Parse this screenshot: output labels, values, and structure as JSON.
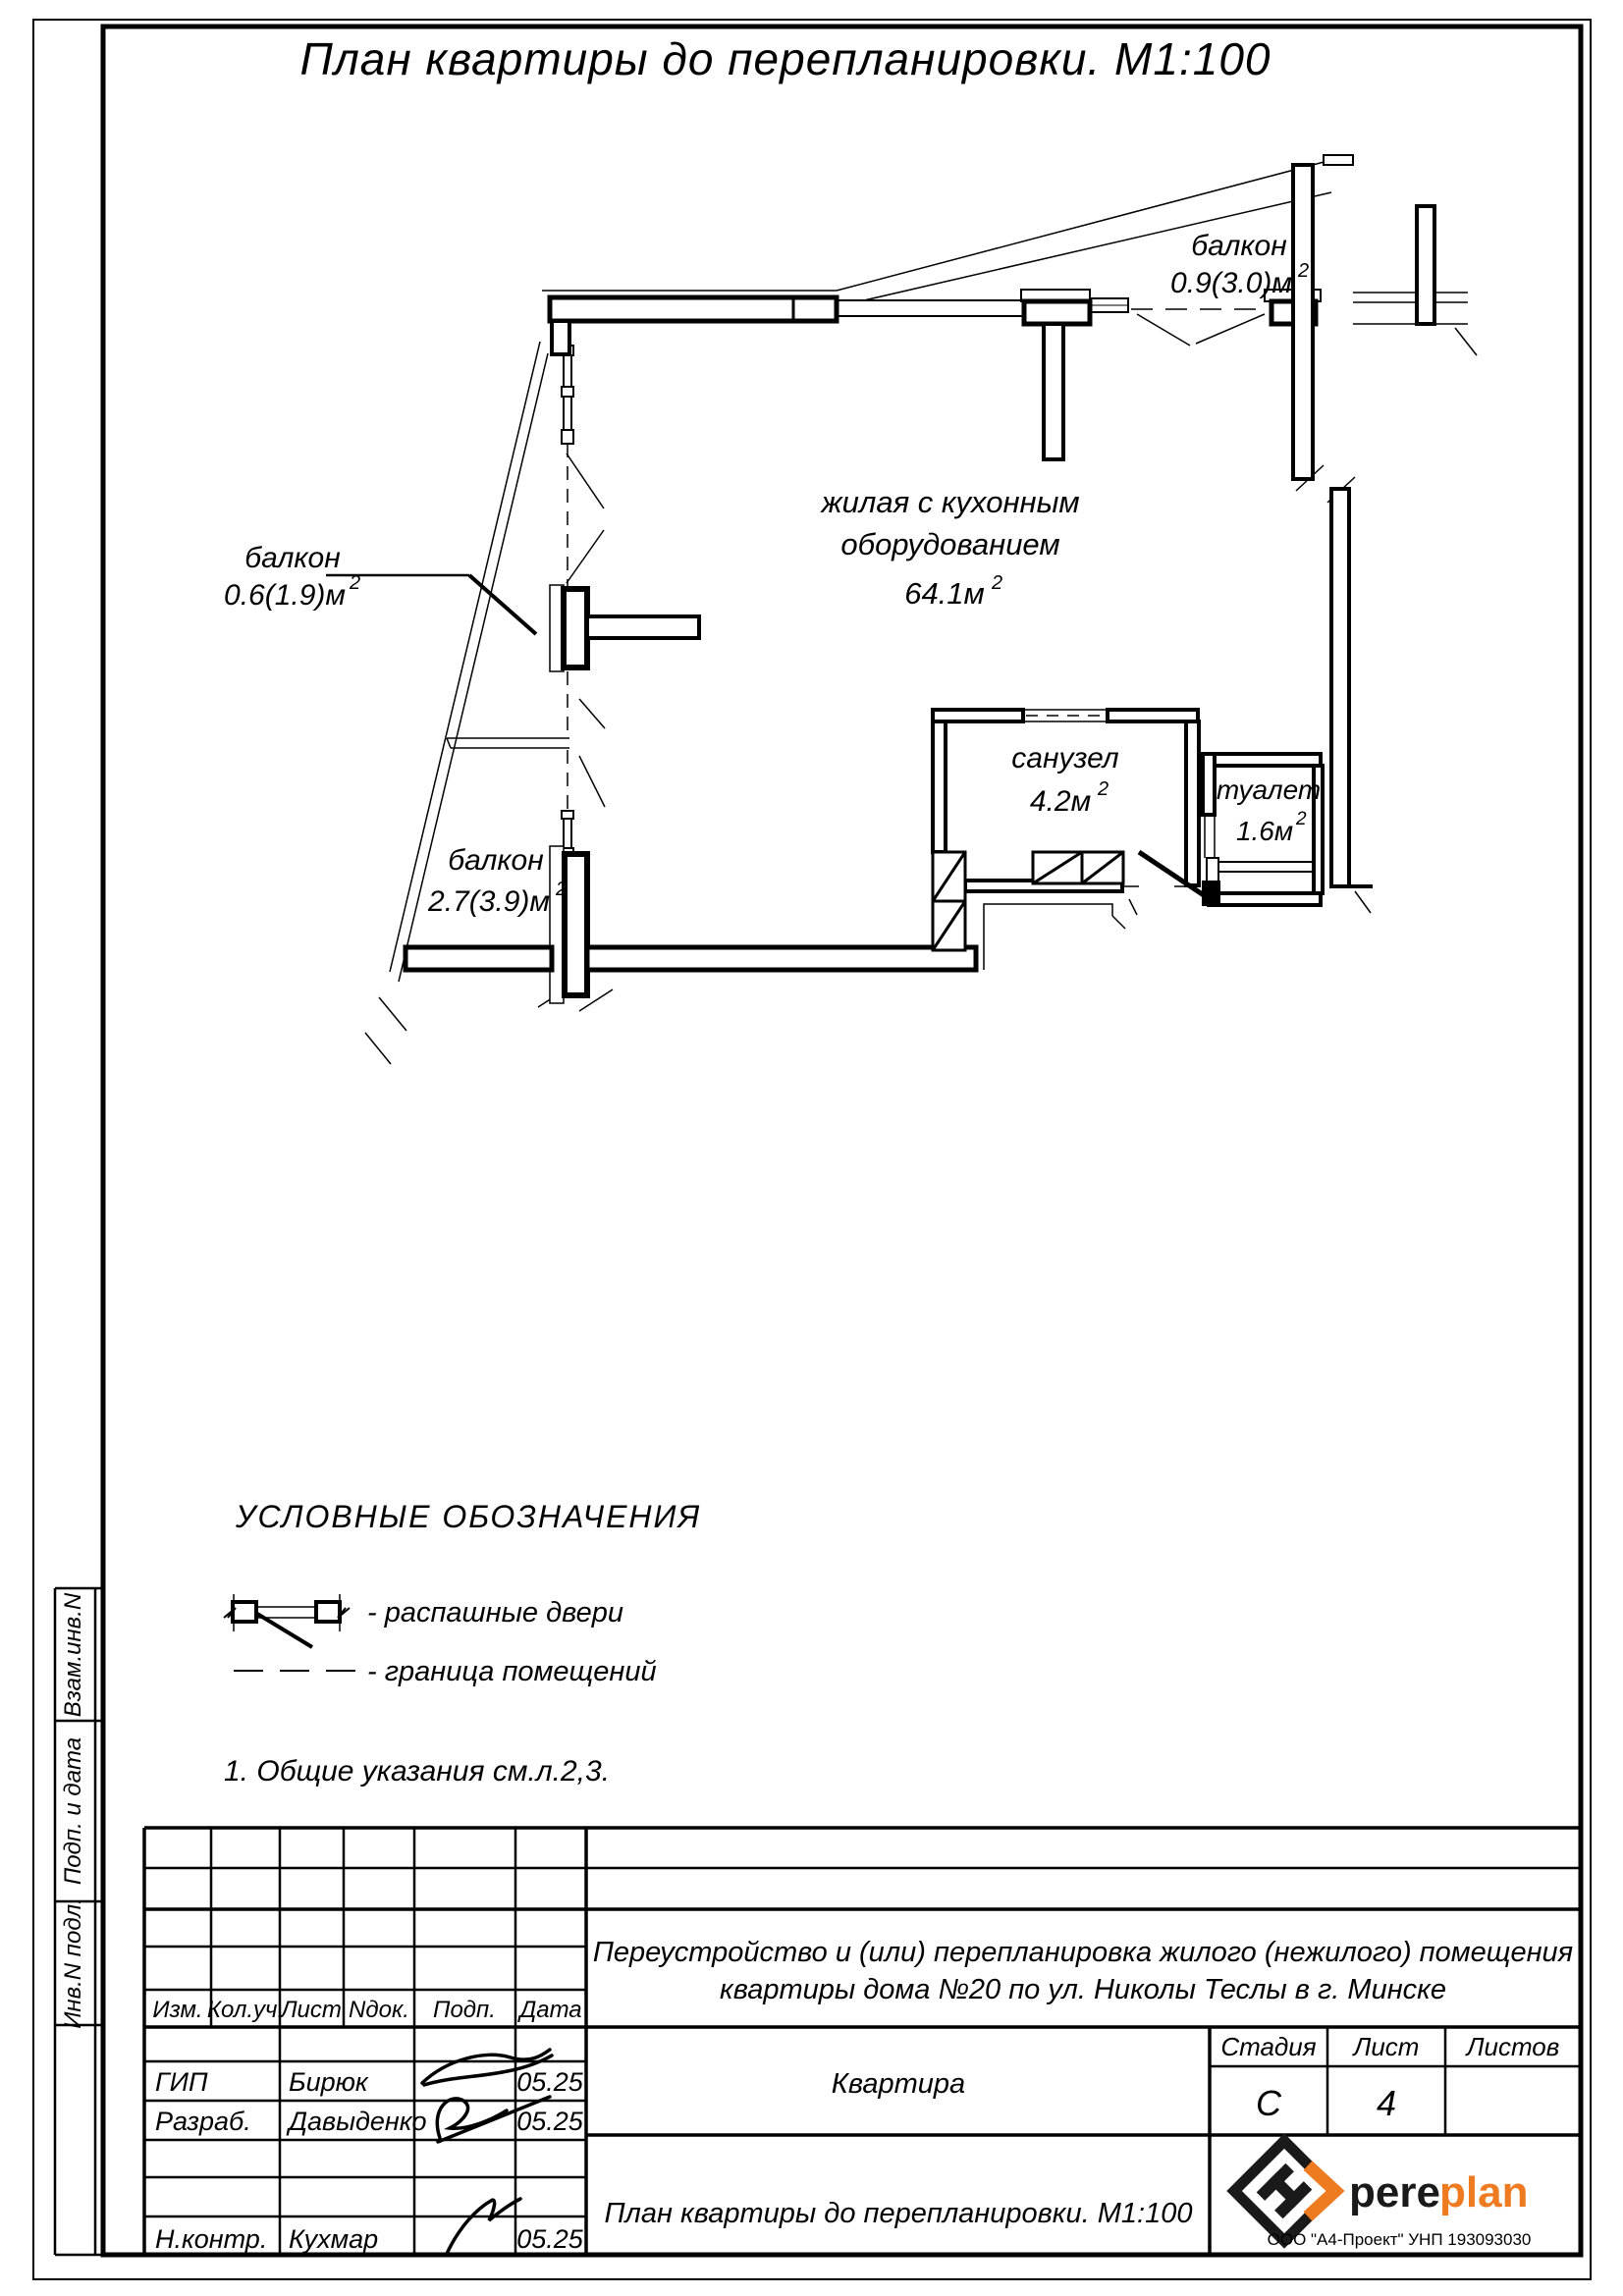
{
  "page": {
    "title": "План квартиры до  перепланировки. М1:100"
  },
  "plan": {
    "sup": "2",
    "living": {
      "l1": "жилая с кухонным",
      "l2": "оборудованием",
      "area": "64.1м"
    },
    "balcony_top": {
      "label": "балкон",
      "area": "0.9(3.0)м"
    },
    "balcony_mid": {
      "label": "балкон",
      "area": "0.6(1.9)м"
    },
    "balcony_low": {
      "label": "балкон",
      "area": "2.7(3.9)м"
    },
    "bathroom": {
      "label": "санузел",
      "area": "4.2м"
    },
    "toilet": {
      "label": "туалет",
      "area": "1.6м"
    }
  },
  "legend": {
    "header": "УСЛОВНЫЕ ОБОЗНАЧЕНИЯ",
    "doors": "-  распашные двери",
    "boundary": "-  граница помещений",
    "note": "1.  Общие указания см.л.2,3."
  },
  "stamp_side": {
    "v1": "Взам.инв.N",
    "v2": "Подп. и дата",
    "v3": "Инв.N подл."
  },
  "titleblock": {
    "cols": {
      "izm": "Изм.",
      "kol": "Кол.уч.",
      "list": "Лист",
      "ndok": "Nдок.",
      "podp": "Подп.",
      "data": "Дата"
    },
    "rows": [
      {
        "role": "ГИП",
        "name": "Бирюк",
        "date": "05.25"
      },
      {
        "role": "Разраб.",
        "name": "Давыденко",
        "date": "05.25"
      },
      {
        "role": "Н.контр.",
        "name": "Кухмар",
        "date": "05.25"
      }
    ],
    "desc1": "Переустройство и (или) перепланировка жилого (нежилого) помещения",
    "desc2": "квартиры дома №20 по ул. Николы Теслы в г. Минске",
    "object": "Квартира",
    "stage_label": "Стадия",
    "sheet_label": "Лист",
    "sheets_label": "Листов",
    "stage": "С",
    "sheet": "4",
    "doc": "План квартиры до  перепланировки. М1:100",
    "logo": {
      "black": "pere",
      "orange": "plan",
      "company": "ООО \"А4-Проект\" УНП 193093030"
    }
  },
  "colors": {
    "accent": "#EF7B21",
    "ink": "#000000",
    "paper": "#FFFFFF"
  }
}
